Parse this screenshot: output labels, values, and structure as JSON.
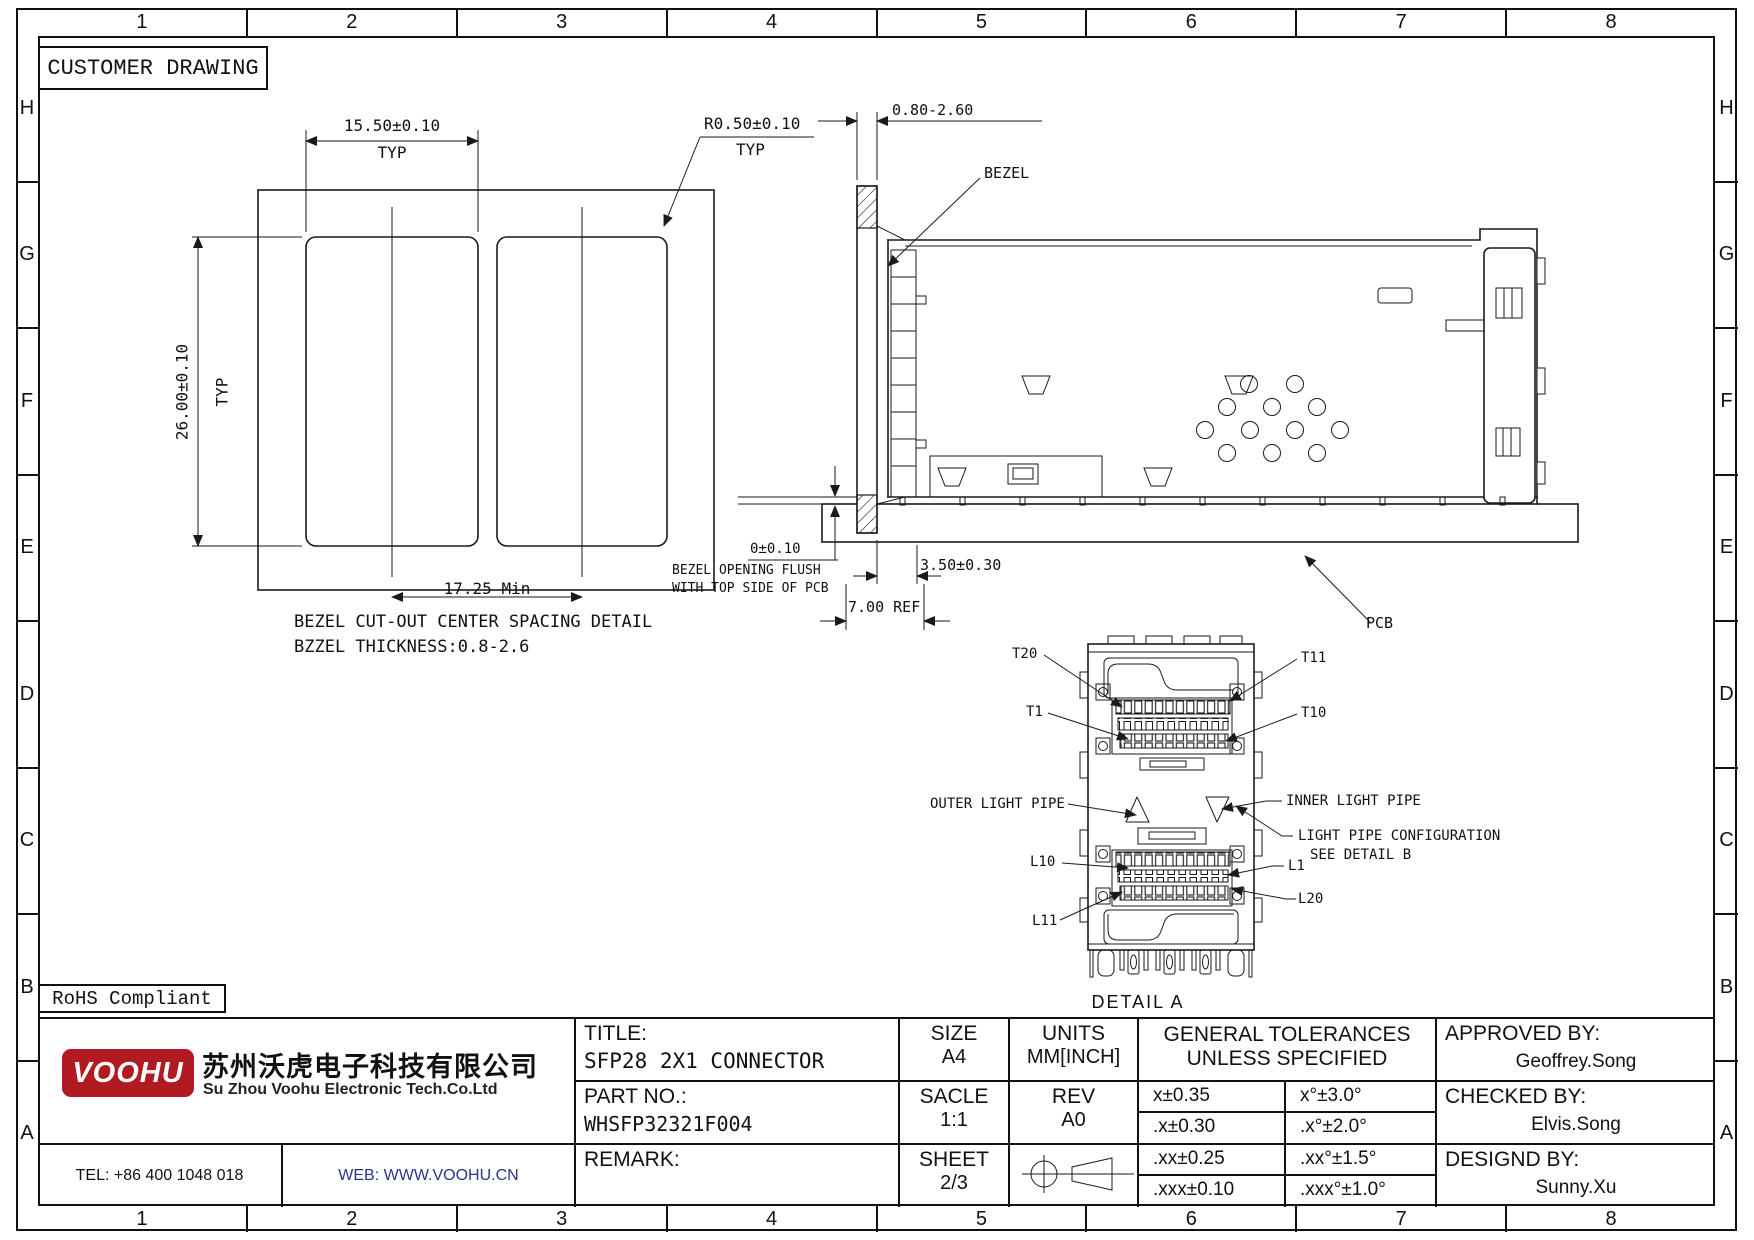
{
  "frame": {
    "customer_drawing": "CUSTOMER DRAWING",
    "rohs": "RoHS Compliant"
  },
  "grid": {
    "cols": [
      "1",
      "2",
      "3",
      "4",
      "5",
      "6",
      "7",
      "8"
    ],
    "rows": [
      "H",
      "G",
      "F",
      "E",
      "D",
      "C",
      "B",
      "A"
    ]
  },
  "bezel_detail": {
    "dim_width": "15.50±0.10",
    "dim_width_suffix": "TYP",
    "dim_height": "26.00±0.10",
    "dim_height_suffix": "TYP",
    "dim_radius": "R0.50±0.10",
    "dim_radius_suffix": "TYP",
    "dim_spacing": "17.25 Min",
    "caption_1": "BEZEL CUT-OUT CENTER SPACING DETAIL",
    "caption_2": "BZZEL THICKNESS:0.8-2.6"
  },
  "side_view": {
    "dim_thickness": "0.80-2.60",
    "label_bezel": "BEZEL",
    "dim_flush": "0±0.10",
    "note_flush_1": "BEZEL OPENING FLUSH",
    "note_flush_2": "WITH TOP SIDE OF PCB",
    "dim_offset": "3.50±0.30",
    "dim_ref": "7.00 REF",
    "label_pcb": "PCB"
  },
  "detail_a": {
    "t20": "T20",
    "t11": "T11",
    "t1": "T1",
    "t10": "T10",
    "outer_light_pipe": "OUTER LIGHT PIPE",
    "inner_light_pipe": "INNER LIGHT PIPE",
    "light_pipe_note_1": "LIGHT PIPE CONFIGURATION",
    "light_pipe_note_2": "SEE DETAIL B",
    "l10": "L10",
    "l1": "L1",
    "l11": "L11",
    "l20": "L20",
    "caption": "DETAIL A"
  },
  "title_block": {
    "logo_text": "VOOHU",
    "company_cn": "苏州沃虎电子科技有限公司",
    "company_en": "Su Zhou Voohu Electronic Tech.Co.Ltd",
    "tel": "TEL: +86 400 1048 018",
    "web": "WEB: WWW.VOOHU.CN",
    "title_label": "TITLE:",
    "title_value": "SFP28 2X1 CONNECTOR",
    "part_label": "PART NO.:",
    "part_value": "WHSFP32321F004",
    "remark_label": "REMARK:",
    "size_label": "SIZE",
    "size_value": "A4",
    "scale_label": "SACLE",
    "scale_value": "1:1",
    "sheet_label": "SHEET",
    "sheet_value": "2/3",
    "units_label": "UNITS",
    "units_value": "MM[INCH]",
    "rev_label": "REV",
    "rev_value": "A0",
    "tol_header_1": "GENERAL TOLERANCES",
    "tol_header_2": "UNLESS SPECIFIED",
    "tol_rows": [
      {
        "lin": "x±0.35",
        "ang": "x°±3.0°"
      },
      {
        "lin": ".x±0.30",
        "ang": ".x°±2.0°"
      },
      {
        "lin": ".xx±0.25",
        "ang": ".xx°±1.5°"
      },
      {
        "lin": ".xxx±0.10",
        "ang": ".xxx°±1.0°"
      }
    ],
    "approved_label": "APPROVED BY:",
    "approved_value": "Geoffrey.Song",
    "checked_label": "CHECKED BY:",
    "checked_value": "Elvis.Song",
    "designed_label": "DESIGND BY:",
    "designed_value": "Sunny.Xu"
  },
  "colors": {
    "brand_red": "#b11a21",
    "web_blue": "#27348b",
    "line": "#1a1a1a"
  }
}
